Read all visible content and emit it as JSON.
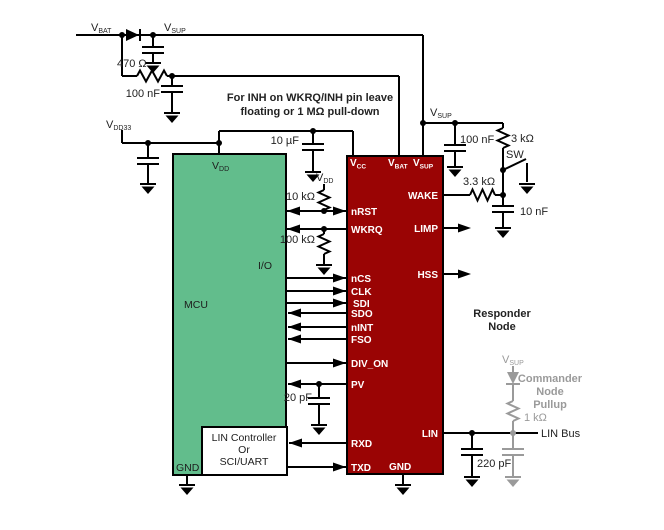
{
  "supplies": {
    "vbat_top": {
      "sym": "V",
      "sub": "BAT"
    },
    "vsup_top": {
      "sym": "V",
      "sub": "SUP"
    },
    "vdd33": {
      "sym": "V",
      "sub": "DD33"
    },
    "vdd_rail": {
      "sym": "V",
      "sub": "DD"
    },
    "vsup_node": {
      "sym": "V",
      "sub": "SUP"
    },
    "vsup_commander": {
      "sym": "V",
      "sub": "SUP"
    }
  },
  "note": {
    "line1": "For INH on WKRQ/INH pin leave",
    "line2": "floating or 1 MΩ pull-down"
  },
  "components": {
    "r470": "470 Ω",
    "c100n_vbat": "100 nF",
    "c10u": "10 µF",
    "r10k": "10 kΩ",
    "r100k": "100 kΩ",
    "c100n_vsup": "100 nF",
    "r3k": "3 kΩ",
    "sw": "SW",
    "r3k3": "3.3 kΩ",
    "c10n": "10 nF",
    "c20p": "20 pF",
    "c220p": "220 pF",
    "r1k": "1 kΩ"
  },
  "mcu": {
    "name": "MCU",
    "vdd": {
      "sym": "V",
      "sub": "DD"
    },
    "io": "I/O",
    "gnd": "GND",
    "controller": [
      "LIN Controller",
      "Or",
      "SCI/UART"
    ]
  },
  "transceiver": {
    "top_pins": [
      {
        "sym": "V",
        "sub": "CC"
      },
      {
        "sym": "V",
        "sub": "BAT"
      },
      {
        "sym": "V",
        "sub": "SUP"
      }
    ],
    "left_pins": [
      "nRST",
      "WKRQ",
      "nCS",
      "CLK",
      "SDI",
      "SDO",
      "nINT",
      "FSO",
      "DIV_ON",
      "PV",
      "RXD",
      "TXD"
    ],
    "right_pins": [
      "WAKE",
      "LIMP",
      "HSS",
      "LIN"
    ],
    "gnd": "GND"
  },
  "annotations": {
    "responder": [
      "Responder",
      "Node"
    ],
    "commander": [
      "Commander",
      "Node",
      "Pullup"
    ],
    "lin_bus": "LIN Bus"
  },
  "colors": {
    "mcu_fill": "#62bd8c",
    "transceiver_fill": "#9a0404",
    "muted": "#9a9a9a"
  }
}
